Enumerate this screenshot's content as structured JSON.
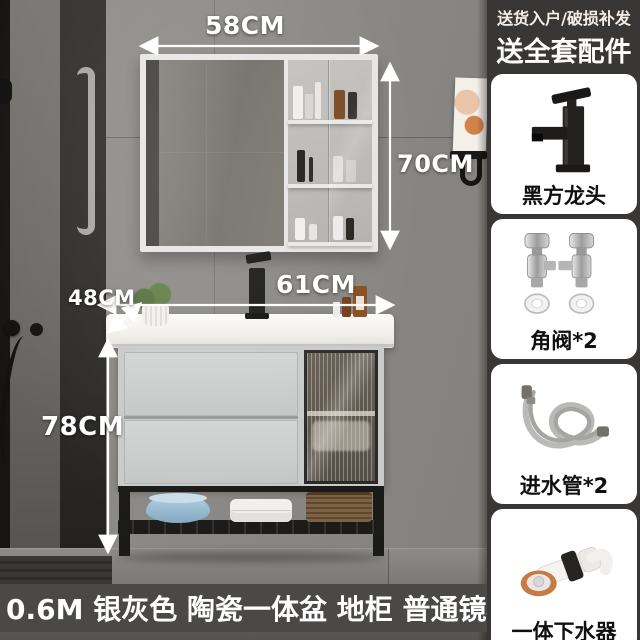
{
  "scene": {
    "dimensions": {
      "mirror_width": "58CM",
      "mirror_height": "70CM",
      "counter_width": "61CM",
      "counter_depth": "48CM",
      "cabinet_height": "78CM"
    },
    "caption": "0.6M 银灰色 陶瓷一体盆 地柜 普通镜柜"
  },
  "sidebar": {
    "tagline": "送货入户/破损补发",
    "headline": "送全套配件",
    "cards": [
      {
        "label": "黑方龙头",
        "icon": "black-square-faucet-image"
      },
      {
        "label": "角阀*2",
        "icon": "angle-valves-image"
      },
      {
        "label": "进水管*2",
        "icon": "inlet-hoses-image"
      },
      {
        "label": "一体下水器",
        "icon": "integrated-drain-image"
      }
    ]
  },
  "colors": {
    "sidebar_bg": "#393735",
    "caption_bg": "#4a4947",
    "card_bg": "#ffffff",
    "card_text": "#101010",
    "annotation_text": "#ffffff"
  }
}
